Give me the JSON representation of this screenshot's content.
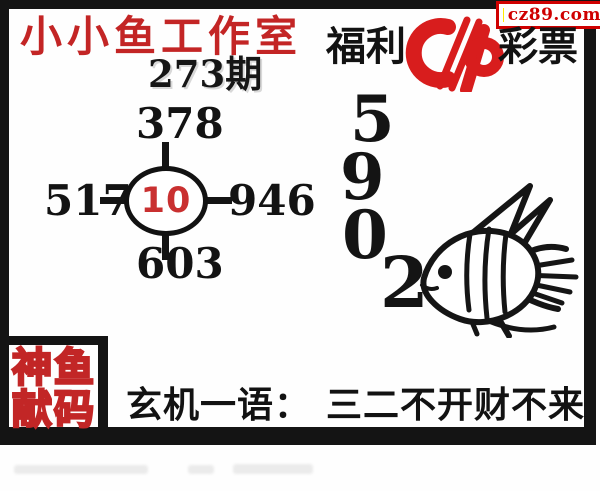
{
  "badge": {
    "text": "cz89.com",
    "icon": "yellow-square-icon",
    "accent": "#cf0000",
    "square_color": "#ffec00"
  },
  "header": {
    "studio_title": "小小鱼工作室",
    "issue": "273期",
    "brand": {
      "prefix": "福利",
      "suffix": "彩票",
      "logo": "cp-lottery-logo",
      "logo_color": "#d81d1d"
    }
  },
  "number_diagram": {
    "center": "10",
    "top": "378",
    "left": "517",
    "right": "946",
    "bottom": "603",
    "center_color": "#c93030"
  },
  "main_numbers": {
    "digits": [
      "5",
      "9",
      "0",
      "2"
    ]
  },
  "fish": {
    "icon": "angelfish-line-art"
  },
  "code_stamp": {
    "line1": "神鱼",
    "line2": "献码",
    "outline_color": "#c22626"
  },
  "hint_bar": {
    "label": "玄机一语：",
    "text": "三二不开财不来"
  },
  "footer": {
    "watermark_legible": false
  },
  "colors": {
    "frame": "#141414",
    "title_red": "#c32525",
    "text_black": "#121212",
    "background": "#fefefe"
  }
}
